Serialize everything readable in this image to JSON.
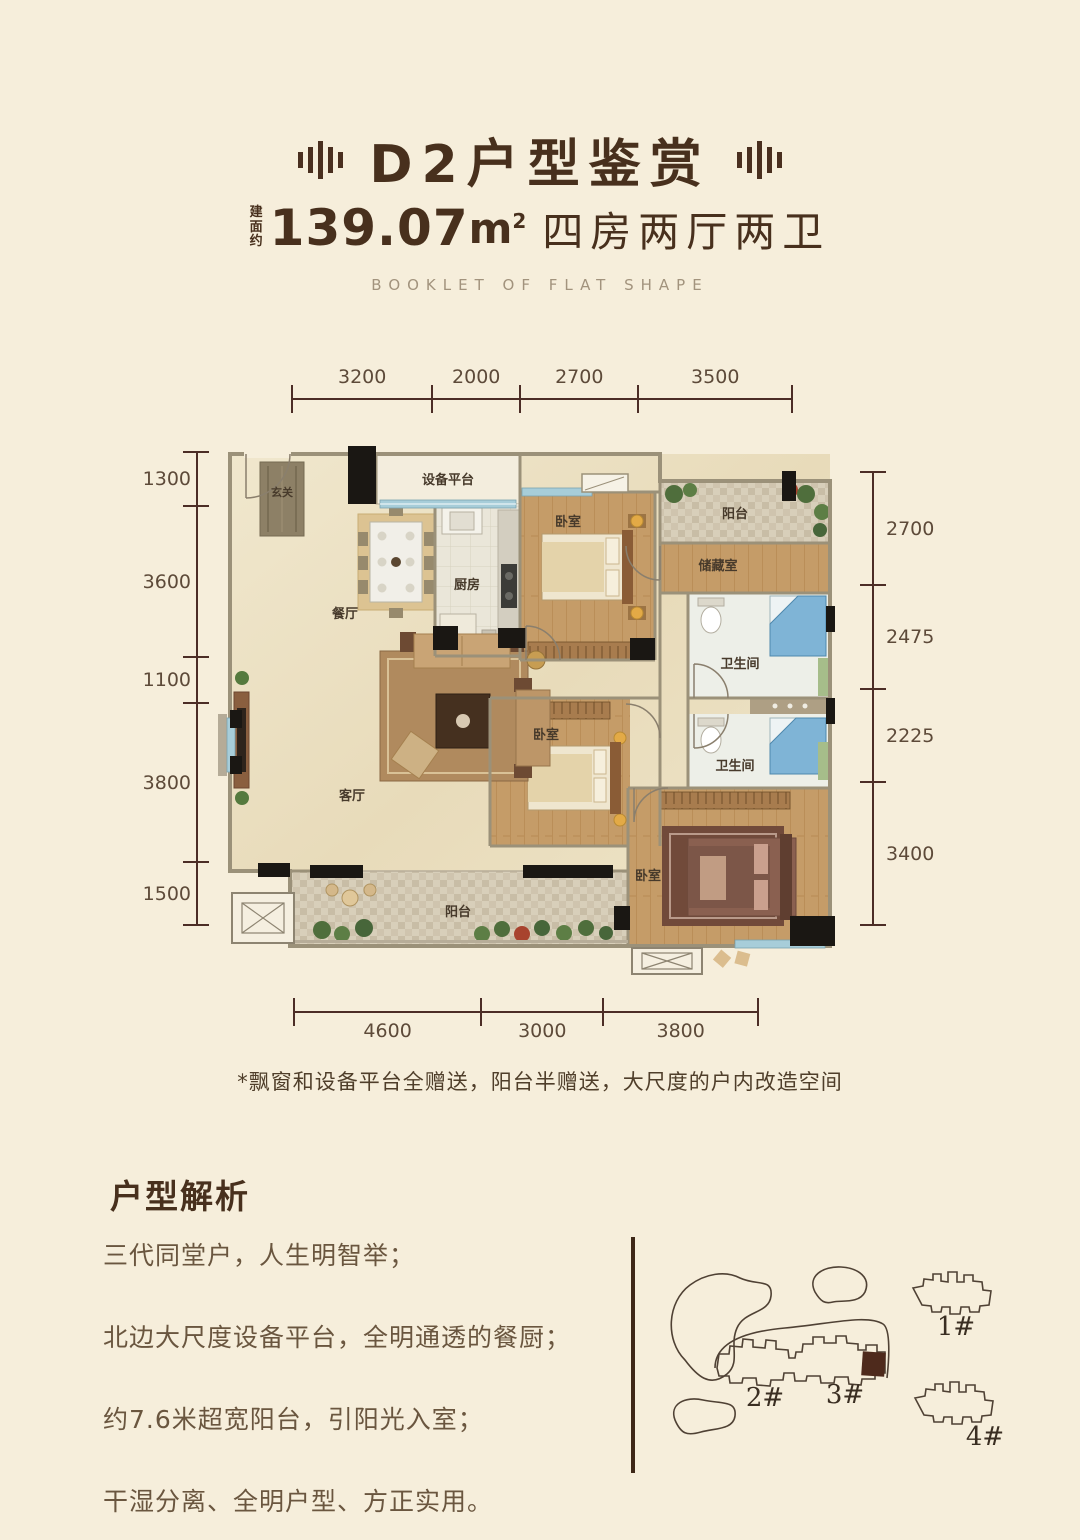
{
  "page": {
    "background": "#f6eedb",
    "accent": "#4a2f1f"
  },
  "header": {
    "decor_icon": "bars-emblem",
    "title": "D2户型鉴赏",
    "area_prefix": "建面约",
    "area_value": "139.07",
    "area_unit_base": "m",
    "area_unit_sup": "2",
    "layout_text": "四房两厅两卫",
    "subtitle_en": "BOOKLET OF FLAT SHAPE"
  },
  "dimensions": {
    "top": [
      "3200",
      "2000",
      "2700",
      "3500"
    ],
    "left": [
      "1300",
      "3600",
      "1100",
      "3800",
      "1500"
    ],
    "right": [
      "2700",
      "2475",
      "2225",
      "3400"
    ],
    "bottom": [
      "4600",
      "3000",
      "3800"
    ]
  },
  "floorplan": {
    "rooms": {
      "entry": "玄关",
      "equipment": "设备平台",
      "kitchen": "厨房",
      "dining": "餐厅",
      "bedroom": "卧室",
      "balcony": "阳台",
      "storage": "储藏室",
      "bathroom": "卫生间",
      "living": "客厅"
    }
  },
  "footnote": "*飘窗和设备平台全赠送，阳台半赠送，大尺度的户内改造空间",
  "analysis": {
    "heading": "户型解析",
    "points": [
      "三代同堂户，人生明智举；",
      "北边大尺度设备平台，全明通透的餐厨；",
      "约7.6米超宽阳台，引阳光入室；",
      "干湿分离、全明户型、方正实用。"
    ]
  },
  "sitemap": {
    "buildings": [
      "1#",
      "2#",
      "3#",
      "4#"
    ]
  }
}
